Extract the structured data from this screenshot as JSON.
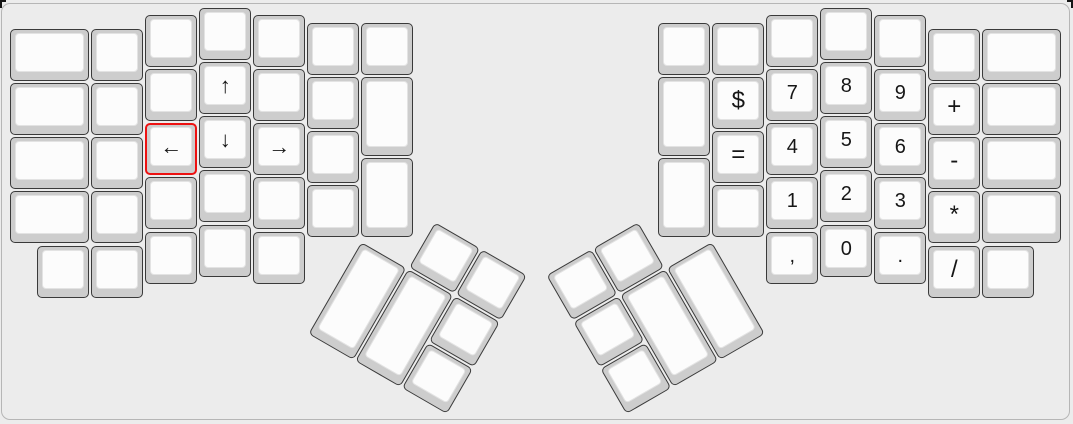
{
  "app": {
    "view": "keyboard-layout-canvas"
  },
  "canvas": {
    "background": "#ececec",
    "border_color": "#b6b6b6"
  },
  "key_style": {
    "base_color": "#cdcdcd",
    "top_color": "#fcfcfc",
    "border_color": "#3a3a3a",
    "legend_color": "#161616",
    "selected_outline_color": "#ed1111"
  },
  "layout": {
    "unit_px": 54
  },
  "selection": {
    "selected_key_legend": "←"
  },
  "halves": {
    "left_main": [
      {
        "x": 9.3,
        "y": 28,
        "w": 1.5,
        "label": ""
      },
      {
        "x": 9.3,
        "y": 82,
        "w": 1.5,
        "label": ""
      },
      {
        "x": 9.3,
        "y": 136,
        "w": 1.5,
        "label": ""
      },
      {
        "x": 9.3,
        "y": 190,
        "w": 1.5,
        "label": ""
      },
      {
        "x": 90.3,
        "y": 28,
        "label": ""
      },
      {
        "x": 90.3,
        "y": 82,
        "label": ""
      },
      {
        "x": 90.3,
        "y": 136,
        "label": ""
      },
      {
        "x": 90.3,
        "y": 190,
        "label": ""
      },
      {
        "x": 144.3,
        "y": 14,
        "label": ""
      },
      {
        "x": 144.3,
        "y": 68,
        "label": ""
      },
      {
        "x": 144.3,
        "y": 122,
        "label": "←",
        "selected": true
      },
      {
        "x": 144.3,
        "y": 176,
        "label": ""
      },
      {
        "x": 144.3,
        "y": 231,
        "label": ""
      },
      {
        "x": 198.3,
        "y": 7,
        "label": ""
      },
      {
        "x": 198.3,
        "y": 61,
        "label": "↑"
      },
      {
        "x": 198.3,
        "y": 115,
        "label": "↓"
      },
      {
        "x": 198.3,
        "y": 169,
        "label": ""
      },
      {
        "x": 198.3,
        "y": 224,
        "label": ""
      },
      {
        "x": 252.3,
        "y": 14,
        "label": ""
      },
      {
        "x": 252.3,
        "y": 68,
        "label": ""
      },
      {
        "x": 252.3,
        "y": 122,
        "label": "→"
      },
      {
        "x": 252.3,
        "y": 176,
        "label": ""
      },
      {
        "x": 252.3,
        "y": 231,
        "label": ""
      },
      {
        "x": 306.3,
        "y": 22,
        "label": ""
      },
      {
        "x": 306.3,
        "y": 76,
        "label": ""
      },
      {
        "x": 306.3,
        "y": 130,
        "label": ""
      },
      {
        "x": 306.3,
        "y": 184,
        "label": ""
      },
      {
        "x": 360.3,
        "y": 22,
        "label": ""
      },
      {
        "x": 360.3,
        "y": 76,
        "h": 1.5,
        "label": ""
      },
      {
        "x": 360.3,
        "y": 157,
        "h": 1.5,
        "label": ""
      },
      {
        "x": 36.3,
        "y": 245,
        "label": ""
      },
      {
        "x": 90.3,
        "y": 245,
        "label": ""
      }
    ],
    "right_main": [
      {
        "x": 657.3,
        "y": 22,
        "label": ""
      },
      {
        "x": 657.3,
        "y": 76,
        "h": 1.5,
        "label": ""
      },
      {
        "x": 657.3,
        "y": 157,
        "h": 1.5,
        "label": ""
      },
      {
        "x": 711.3,
        "y": 22,
        "label": ""
      },
      {
        "x": 711.3,
        "y": 76,
        "label": "$"
      },
      {
        "x": 711.3,
        "y": 130,
        "label": "="
      },
      {
        "x": 711.3,
        "y": 184,
        "label": ""
      },
      {
        "x": 765.3,
        "y": 14,
        "label": ""
      },
      {
        "x": 765.3,
        "y": 68,
        "label": "7"
      },
      {
        "x": 765.3,
        "y": 122,
        "label": "4"
      },
      {
        "x": 765.3,
        "y": 176,
        "label": "1"
      },
      {
        "x": 765.3,
        "y": 231,
        "label": ","
      },
      {
        "x": 819.3,
        "y": 7,
        "label": ""
      },
      {
        "x": 819.3,
        "y": 61,
        "label": "8"
      },
      {
        "x": 819.3,
        "y": 115,
        "label": "5"
      },
      {
        "x": 819.3,
        "y": 169,
        "label": "2"
      },
      {
        "x": 819.3,
        "y": 224,
        "label": "0"
      },
      {
        "x": 873.3,
        "y": 14,
        "label": ""
      },
      {
        "x": 873.3,
        "y": 68,
        "label": "9"
      },
      {
        "x": 873.3,
        "y": 122,
        "label": "6"
      },
      {
        "x": 873.3,
        "y": 176,
        "label": "3"
      },
      {
        "x": 873.3,
        "y": 231,
        "label": "."
      },
      {
        "x": 927.3,
        "y": 28,
        "label": ""
      },
      {
        "x": 927.3,
        "y": 82,
        "label": "+"
      },
      {
        "x": 927.3,
        "y": 136,
        "label": "-"
      },
      {
        "x": 927.3,
        "y": 190,
        "label": "*"
      },
      {
        "x": 927.3,
        "y": 245,
        "label": "/"
      },
      {
        "x": 981.3,
        "y": 28,
        "w": 1.5,
        "label": ""
      },
      {
        "x": 981.3,
        "y": 82,
        "w": 1.5,
        "label": ""
      },
      {
        "x": 981.3,
        "y": 136,
        "w": 1.5,
        "label": ""
      },
      {
        "x": 981.3,
        "y": 190,
        "w": 1.5,
        "label": ""
      },
      {
        "x": 981.3,
        "y": 245,
        "label": ""
      }
    ],
    "left_thumb": {
      "origin_x": 388,
      "origin_y": 193.8,
      "rotation_deg": 30,
      "keys": [
        {
          "x": 54,
          "y": 0,
          "label": ""
        },
        {
          "x": 108,
          "y": 0,
          "label": ""
        },
        {
          "x": 0,
          "y": 54,
          "h": 2,
          "label": ""
        },
        {
          "x": 54,
          "y": 54,
          "h": 2,
          "label": ""
        },
        {
          "x": 108,
          "y": 54,
          "label": ""
        },
        {
          "x": 108,
          "y": 108,
          "label": ""
        }
      ]
    },
    "right_thumb": {
      "origin_x": 544.7,
      "origin_y": 274.8,
      "rotation_deg": -30,
      "keys": [
        {
          "x": 0,
          "y": 0,
          "label": ""
        },
        {
          "x": 54,
          "y": 0,
          "label": ""
        },
        {
          "x": 0,
          "y": 54,
          "label": ""
        },
        {
          "x": 0,
          "y": 108,
          "label": ""
        },
        {
          "x": 54,
          "y": 54,
          "h": 2,
          "label": ""
        },
        {
          "x": 108,
          "y": 54,
          "h": 2,
          "label": ""
        }
      ]
    }
  }
}
